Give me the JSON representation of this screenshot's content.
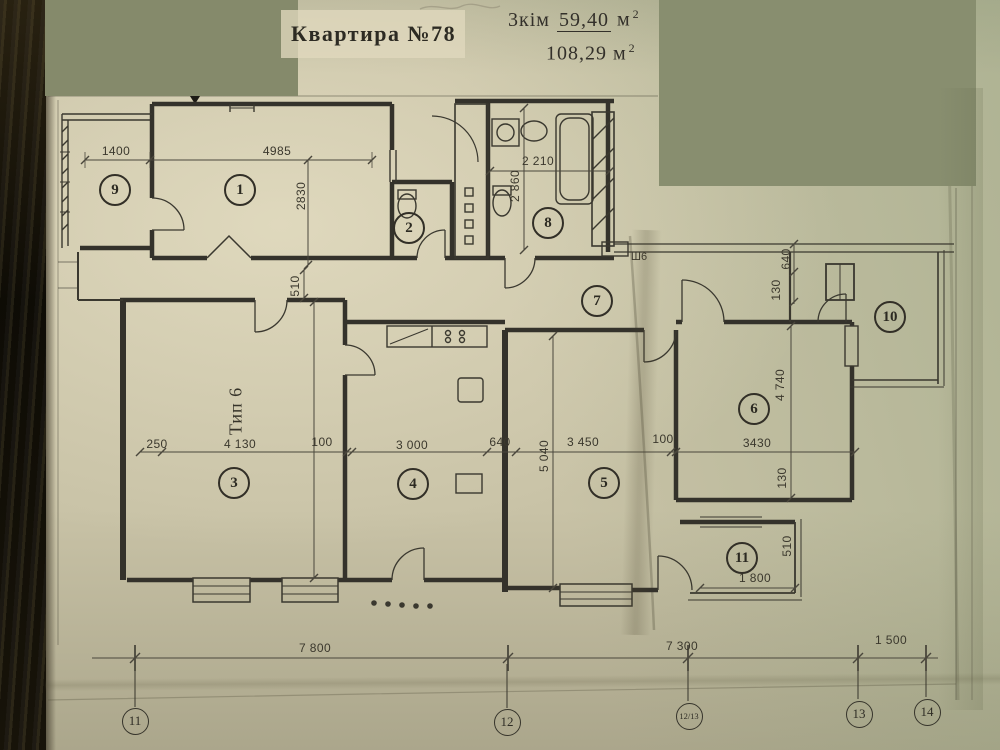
{
  "header": {
    "title": "Квартира №78",
    "rooms_count_label": "3кім",
    "living_area_value": "59,40",
    "total_area_value": "108,29",
    "area_unit": "м",
    "area_unit_exponent": "2"
  },
  "plan": {
    "type_label": "Тип 6",
    "closet_label": "Ш6",
    "room_numbers": [
      {
        "number": "9"
      },
      {
        "number": "1"
      },
      {
        "number": "2"
      },
      {
        "number": "8"
      },
      {
        "number": "7"
      },
      {
        "number": "10"
      },
      {
        "number": "6"
      },
      {
        "number": "3"
      },
      {
        "number": "4"
      },
      {
        "number": "5"
      },
      {
        "number": "11"
      }
    ],
    "dimension_labels": [
      {
        "text": "1400"
      },
      {
        "text": "4985"
      },
      {
        "text": "2830"
      },
      {
        "text": "2 210"
      },
      {
        "text": "2 860"
      },
      {
        "text": "510"
      },
      {
        "text": "640"
      },
      {
        "text": "130"
      },
      {
        "text": "4 740"
      },
      {
        "text": "3430"
      },
      {
        "text": "130"
      },
      {
        "text": "250"
      },
      {
        "text": "4 130"
      },
      {
        "text": "100"
      },
      {
        "text": "3 000"
      },
      {
        "text": "640"
      },
      {
        "text": "5 040"
      },
      {
        "text": "3 450"
      },
      {
        "text": "100"
      },
      {
        "text": "510"
      },
      {
        "text": "1 800"
      },
      {
        "text": "7 800"
      },
      {
        "text": "7 300"
      },
      {
        "text": "1 500"
      }
    ],
    "axis_markers": [
      {
        "label": "11"
      },
      {
        "label": "12"
      },
      {
        "label": "12/13"
      },
      {
        "label": "13"
      },
      {
        "label": "14"
      }
    ]
  }
}
